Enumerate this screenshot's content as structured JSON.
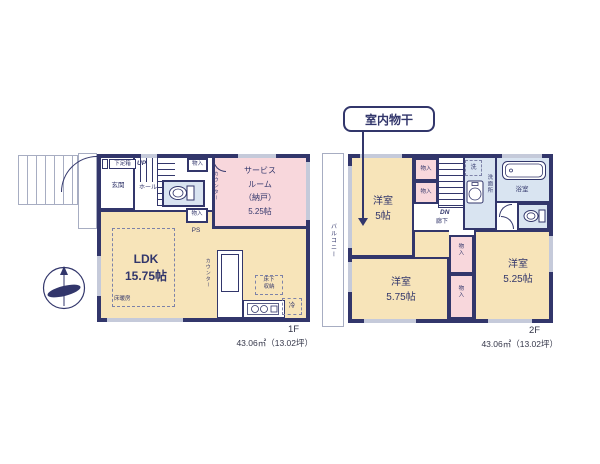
{
  "colors": {
    "wall": "#32366b",
    "room_cream": "#f7e4b9",
    "room_pink": "#f8d7dc",
    "room_blue": "#d9e4f1",
    "window_gray": "#c5cada"
  },
  "floor1": {
    "label": "1F",
    "area": "43.06㎡（13.02坪）",
    "rooms": {
      "genkan": "玄関",
      "shoe_box": "下足箱",
      "up": "UP",
      "hall": "ホール",
      "closet_top": "物入",
      "closet_mid": "物入",
      "ps": "PS",
      "service_room": "サービス\nルーム\n（納戸）\n5.25帖",
      "counter_service": "カウンター",
      "ldk": "LDK\n15.75帖",
      "floor_heating": "床暖房",
      "counter_kitchen": "カウンター",
      "underfloor_storage": "床下\n収納",
      "fridge": "冷"
    }
  },
  "floor2": {
    "label": "2F",
    "area": "43.06㎡（13.02坪）",
    "callout": "室内物干",
    "rooms": {
      "balcony": "バルコニー",
      "bedroom_a": "洋室\n5帖",
      "closet_a": "物入",
      "closet_b": "物入",
      "dn": "DN",
      "hallway": "廊下",
      "washer": "洗",
      "washroom": "洗面所",
      "bathroom": "浴室",
      "bedroom_b": "洋室\n5.75帖",
      "closet_c": "物入",
      "closet_d": "物入",
      "bedroom_c": "洋室\n5.25帖"
    }
  }
}
